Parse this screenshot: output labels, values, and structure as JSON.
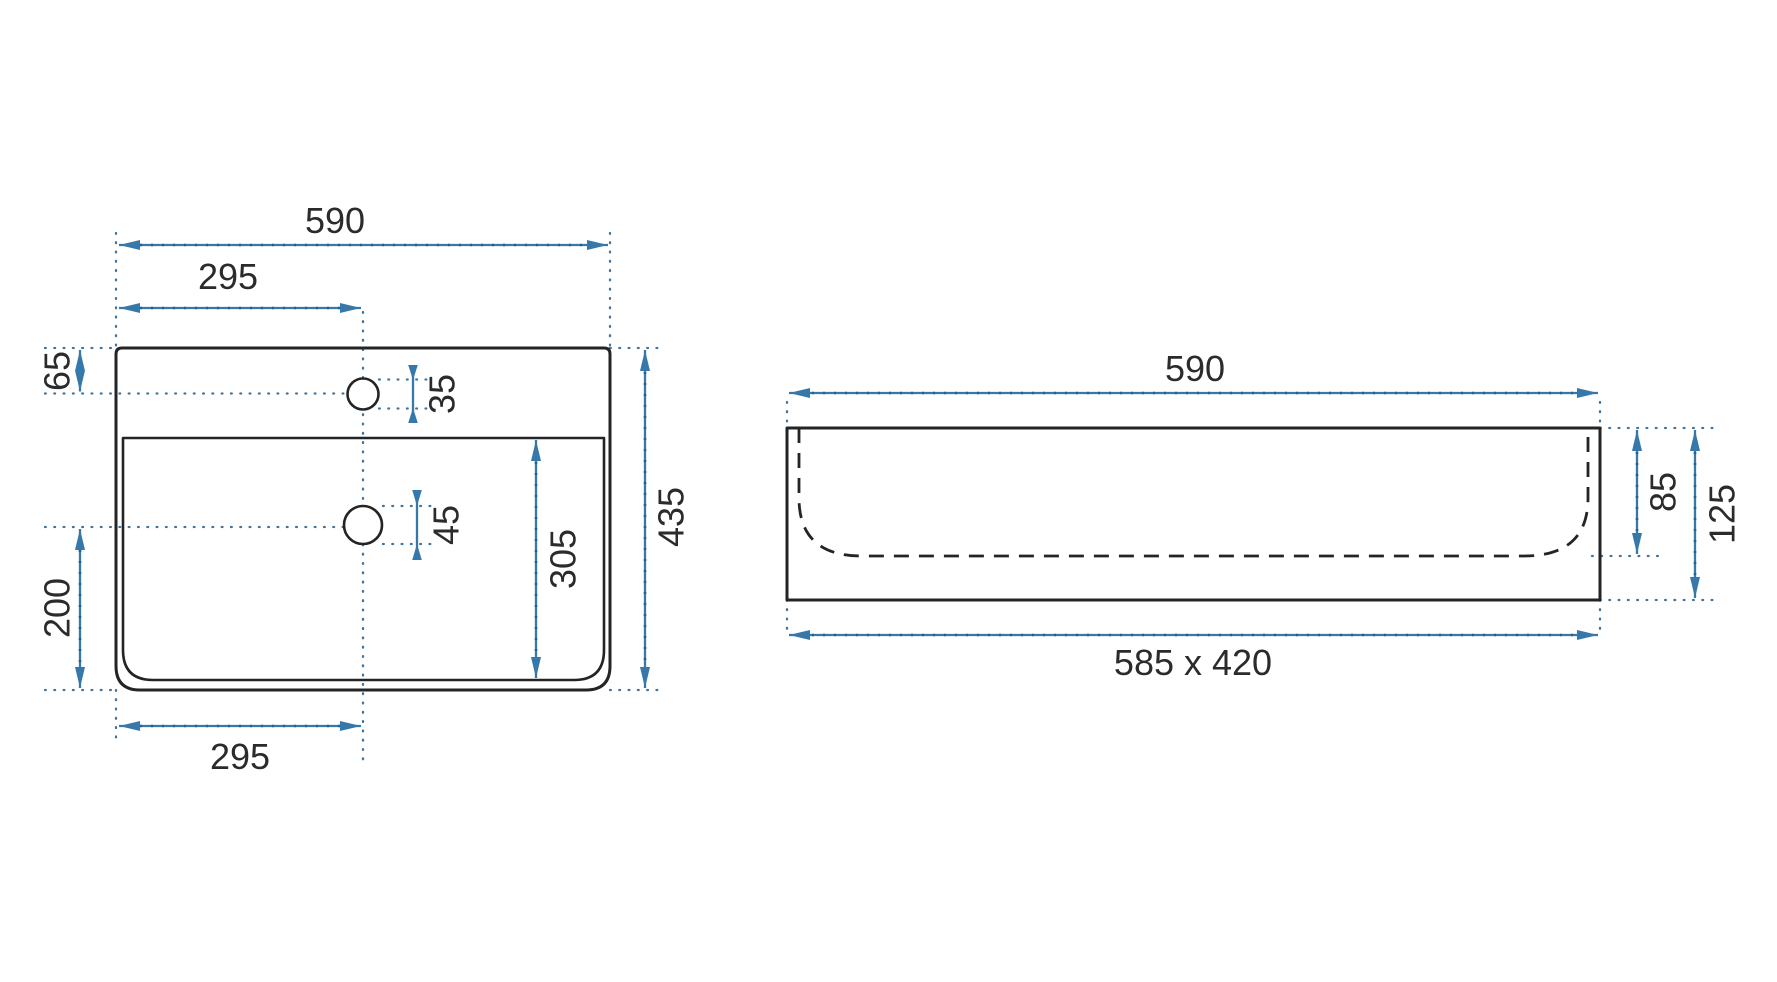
{
  "diagram": {
    "type": "technical-drawing",
    "subject": "wall-hung washbasin dimensions, top view and front view",
    "units_shown": "millimetres (implied, unlabeled)",
    "colors": {
      "background": "#ffffff",
      "outline": "#242424",
      "dimension_accent": "#3578a9",
      "label_text": "#2b2b2b"
    },
    "top_view": {
      "name": "top view (plan) of basin",
      "total_width": "590",
      "half_width_top": "295",
      "faucet_edge_offset": "65",
      "faucet_hole_diameter": "35",
      "drain_hole_diameter": "45",
      "inner_basin_length": "305",
      "drain_to_front_offset": "200",
      "total_depth": "435",
      "half_width_bottom": "295"
    },
    "front_view": {
      "name": "front elevation of basin",
      "total_width": "590",
      "inner_basin_depth": "85",
      "total_height": "125",
      "footprint": "585 x 420"
    }
  }
}
